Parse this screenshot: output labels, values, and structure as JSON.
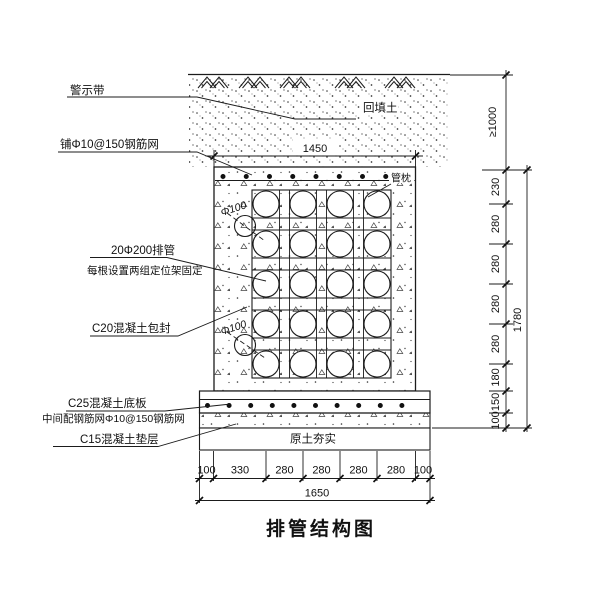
{
  "title": "排管结构图",
  "labels": {
    "warning_tape": "警示带",
    "top_mesh": "铺Φ10@150钢筋网",
    "pipes": "20Φ200排管",
    "pipes_note": "每根设置两组定位架固定",
    "encasement": "C20混凝土包封",
    "base_slab": "C25混凝土底板",
    "base_slab_note": "中间配钢筋网Φ10@150钢筋网",
    "cushion": "C15混凝土垫层",
    "backfill": "回填土",
    "pipe_pillow": "管枕",
    "compacted_soil": "原土夯实",
    "pipe_callout_1": "Φ100",
    "pipe_callout_2": "Φ100"
  },
  "dimensions": {
    "top_width": "1450",
    "min_cover": "≥1000",
    "right_segments": [
      "230",
      "280",
      "280",
      "280",
      "280",
      "180",
      "150",
      "100"
    ],
    "right_total": "1780",
    "bottom_segments": [
      "100",
      "330",
      "280",
      "280",
      "280",
      "280",
      "100"
    ],
    "bottom_total": "1650"
  },
  "structure": {
    "pipe_rows": 5,
    "pipe_cols": 4
  },
  "colors": {
    "line": "#1b1b1b",
    "background": "#ffffff"
  }
}
